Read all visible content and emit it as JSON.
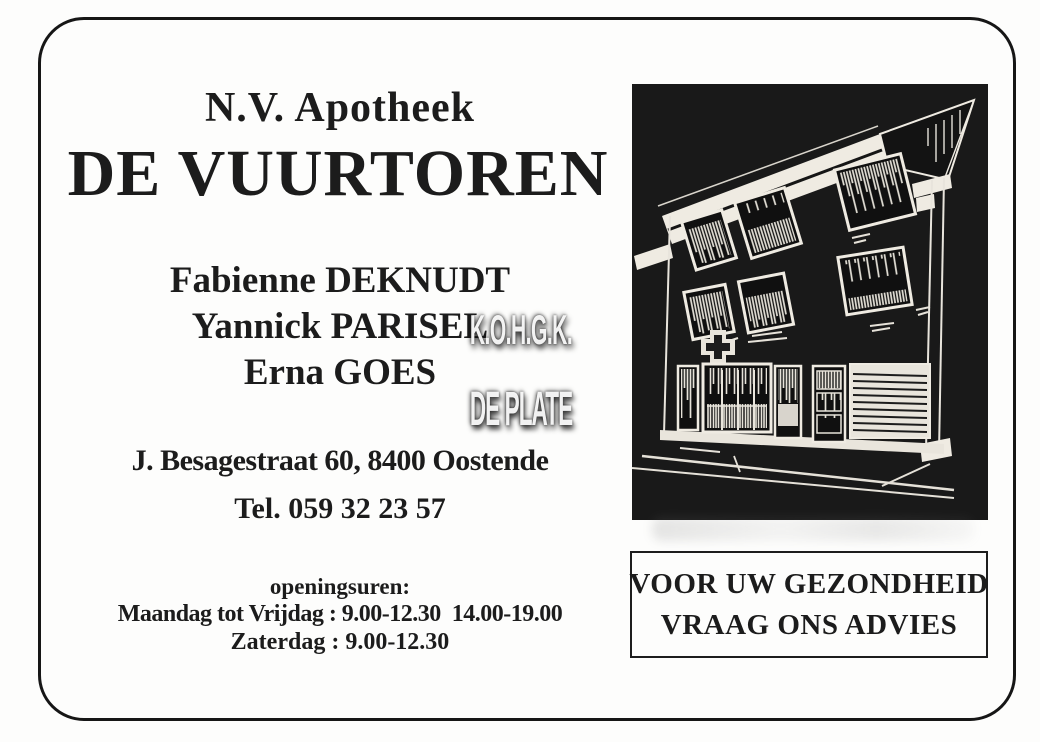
{
  "ad": {
    "company_prefix": "N.V. Apotheek",
    "company_name": "DE VUURTOREN",
    "pharmacists": [
      "Fabienne DEKNUDT",
      "Yannick PARISEL",
      "Erna GOES"
    ],
    "address": "J. Besagestraat 60, 8400 Oostende",
    "phone": "Tel. 059 32 23 57",
    "hours": {
      "title": "openingsuren:",
      "weekdays": "Maandag tot Vrijdag : 9.00-12.30  14.00-19.00",
      "saturday": "Zaterdag : 9.00-12.30"
    },
    "slogan_line1": "VOOR UW GEZONDHEID",
    "slogan_line2": "VRAAG ONS ADVIES"
  },
  "watermark": {
    "line1": "K.O.H.G.K.",
    "line2": "DE PLATE"
  },
  "colors": {
    "ink": "#1c1c1c",
    "paper": "#fdfdfc",
    "photo_background": "#191919",
    "photo_linework": "#ece8df"
  }
}
